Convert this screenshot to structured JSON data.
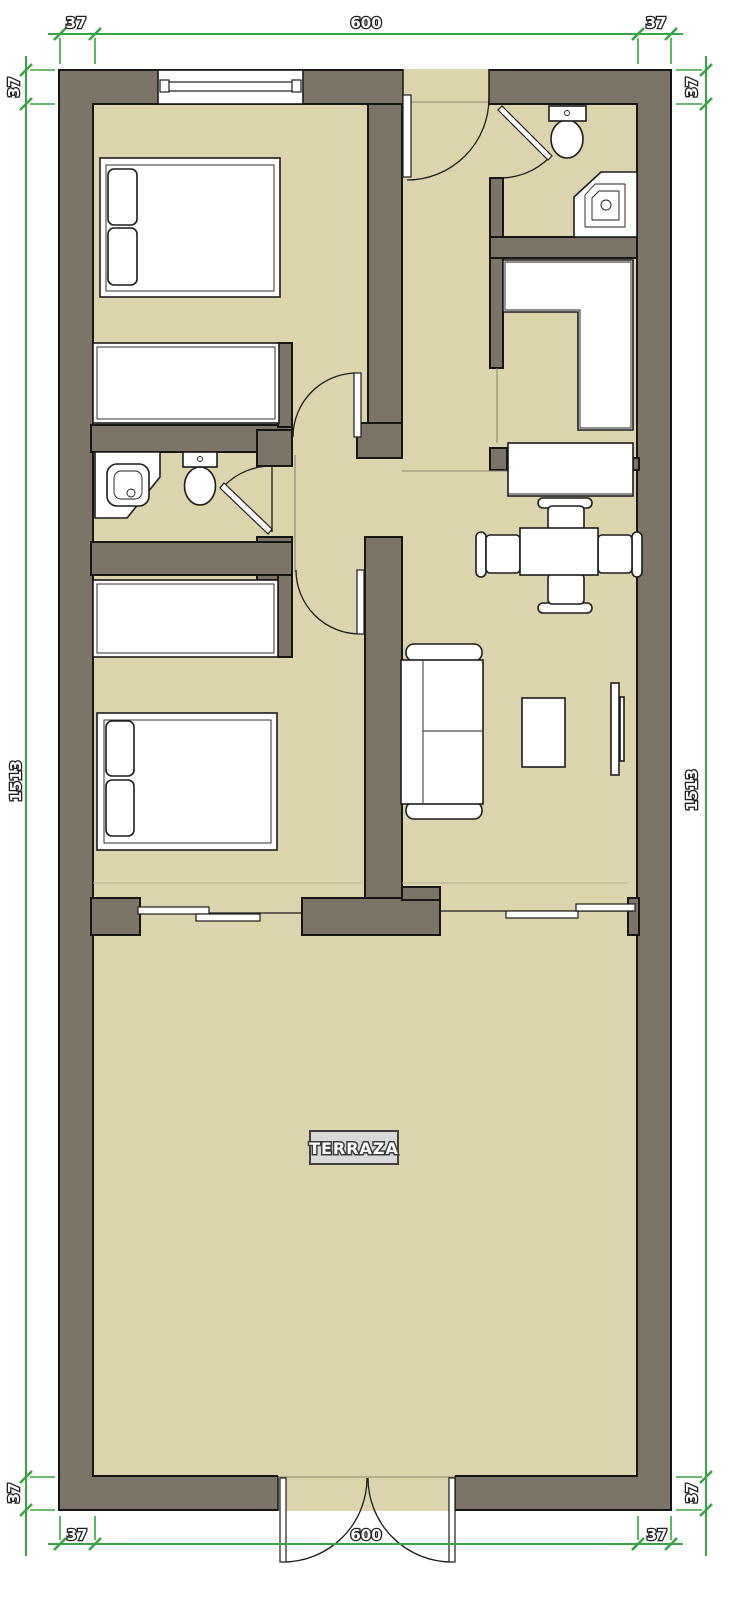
{
  "plan": {
    "terrace_label": "TERRAZA"
  },
  "dims": {
    "top": [
      "37",
      "600",
      "37"
    ],
    "bottom": [
      "37",
      "600",
      "37"
    ],
    "left": [
      "37",
      "1513",
      "37"
    ],
    "right": [
      "37",
      "1513",
      "37"
    ]
  },
  "colors": {
    "wall": "#7b7467",
    "floor": "#dcd5ab",
    "dimension_green": "#3aa344",
    "outline": "#161616",
    "furniture_fill": "#ffffff",
    "terrace_label_bg": "#d9d9d9",
    "background": "#ffffff"
  }
}
